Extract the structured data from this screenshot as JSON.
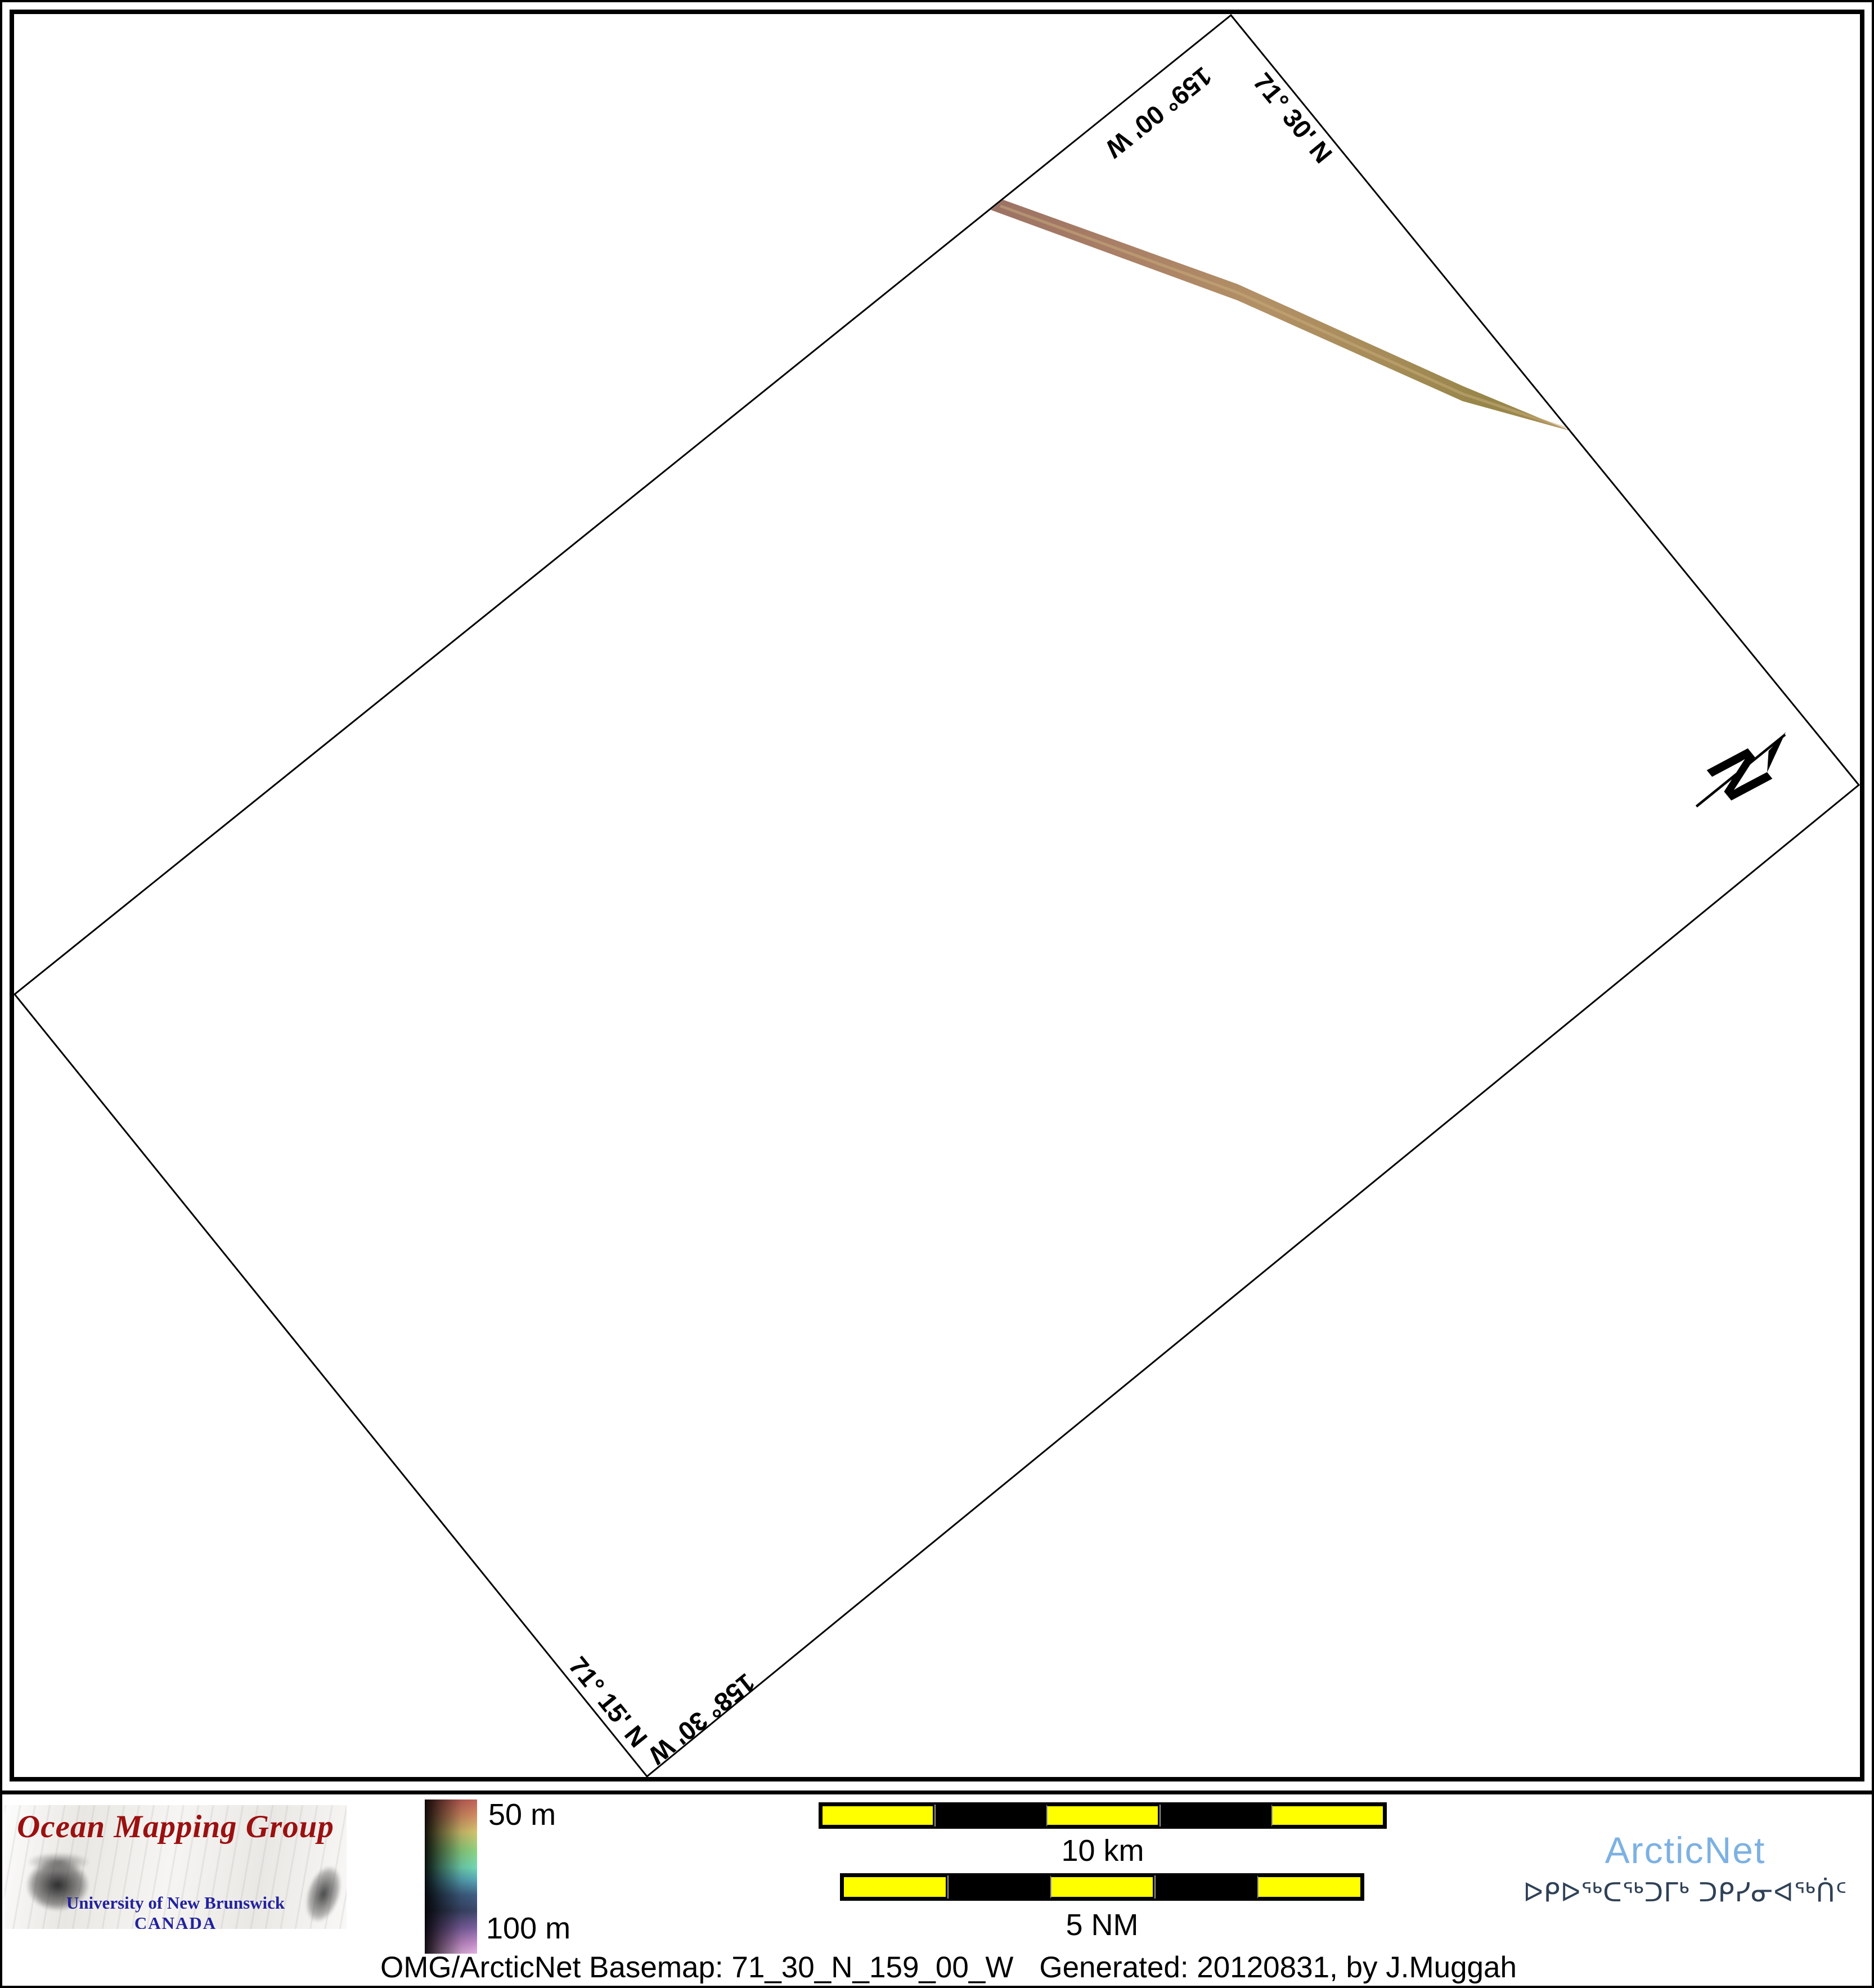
{
  "map": {
    "boundary_labels": {
      "lon_top": "159° 00' W",
      "lat_top": "71° 30' N",
      "lat_bottom": "71° 15' N",
      "lon_bottom": "158° 30' W"
    },
    "north_arrow_label": "N",
    "track": {
      "description": "multibeam-survey-track",
      "color_start": "#9c7264",
      "color_mid": "#b29066",
      "color_end": "#a78e55"
    }
  },
  "footer": {
    "omg_logo": {
      "title": "Ocean Mapping Group",
      "institution": "University of New Brunswick",
      "country": "CANADA",
      "title_color": "#9b1010",
      "institution_color": "#22229e"
    },
    "colorbar": {
      "label_top": "50 m",
      "label_bottom": "100 m",
      "stops": [
        "#c06058",
        "#d28a62",
        "#d4c36e",
        "#8ed27f",
        "#72d8b4",
        "#57a8b8",
        "#3f5f84",
        "#3b4668",
        "#7a5f9e",
        "#c08ac8",
        "#e2b2e0"
      ]
    },
    "scalebars": [
      {
        "label": "10 km",
        "segments": 5,
        "fill": "#ffff00"
      },
      {
        "label": "5 NM",
        "segments": 5,
        "fill": "#ffff00"
      }
    ],
    "arcticnet": {
      "name": "ArcticNet",
      "inuktitut": "ᐅᑭᐅᖅᑕᖅᑐᒥᒃ ᑐᑭᓯᓂᐊᖅᑏᑦ",
      "name_color": "#7db1e3",
      "inuktitut_color": "#2f4156"
    },
    "caption": {
      "basemap": "OMG/ArcticNet Basemap: 71_30_N_159_00_W",
      "generated": "Generated: 20120831, by J.Muggah"
    }
  }
}
